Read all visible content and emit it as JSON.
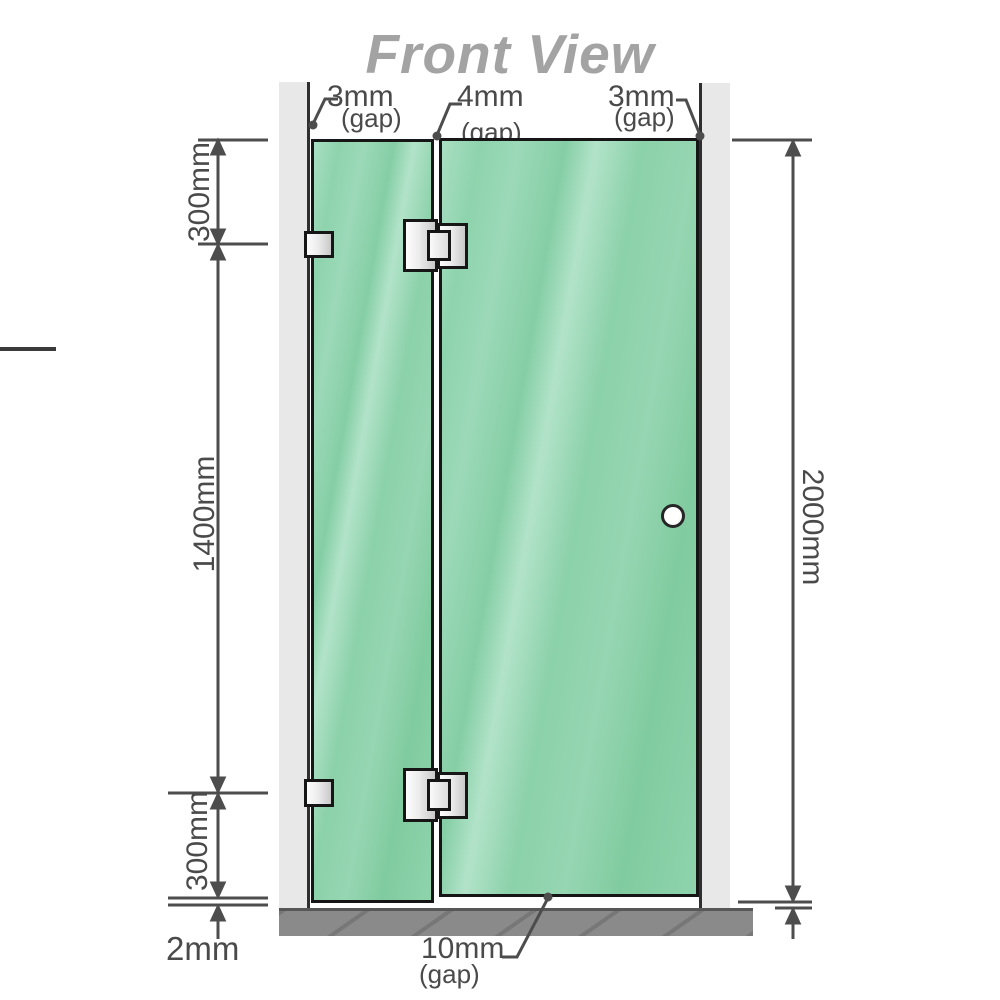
{
  "title": "Front View",
  "gaps": {
    "top_left": {
      "value": "3mm",
      "label": "(gap)"
    },
    "top_middle": {
      "value": "4mm",
      "label": "(gap)"
    },
    "top_right": {
      "value": "3mm",
      "label": "(gap)"
    },
    "bottom_door": {
      "value": "10mm",
      "label": "(gap)"
    },
    "bottom_fixed_panel": {
      "value": "2mm"
    }
  },
  "dimensions": {
    "left_top_segment": "300mm",
    "left_middle_segment": "1400mm",
    "left_bottom_segment": "300mm",
    "right_overall_height": "2000mm"
  },
  "colors": {
    "glass_green": "#8bd0a8",
    "glass_highlight": "#b2e3c9",
    "frame_outline": "#161616",
    "wall_channel": "#e8e8e8",
    "floor_gray": "#8a8a8a",
    "dimension_line": "#4d4d4d",
    "dimension_text": "#4a4a4a",
    "title_gray": "#a3a3a3",
    "hardware_metal": "#ececec"
  },
  "components": {
    "fixed_panel": "fixed glass panel",
    "door_panel": "hinged glass door",
    "hinge_count": 2,
    "wall_bracket_count": 2,
    "door_knob_count": 1
  }
}
